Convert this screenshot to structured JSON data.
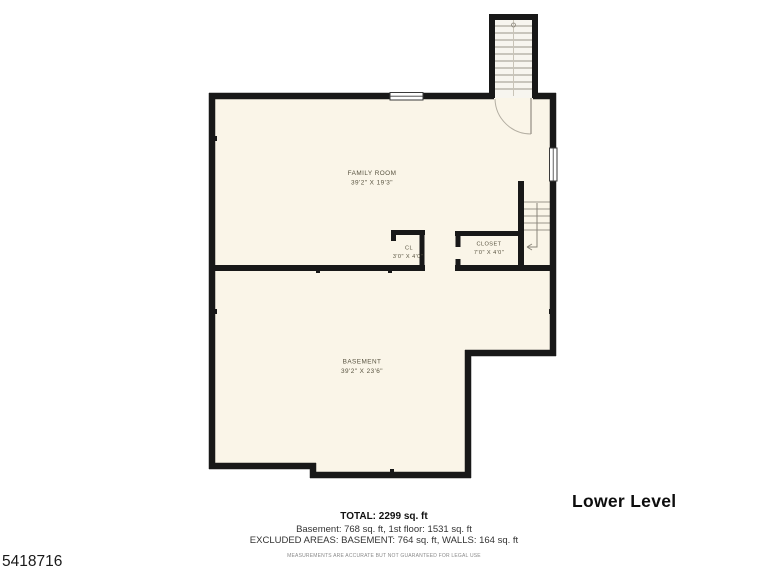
{
  "plan": {
    "wall_color": "#181818",
    "floor_fill": "#faf5e8",
    "stair_fill": "#f7f5ef",
    "detail_color": "#9a958a",
    "rooms": [
      {
        "id": "family-room",
        "name": "FAMILY ROOM",
        "dims": "39'2\" X 19'3\""
      },
      {
        "id": "cl",
        "name": "CL",
        "dims": "3'0\" X 4'0\""
      },
      {
        "id": "closet",
        "name": "CLOSET",
        "dims": "7'0\" X 4'0\""
      },
      {
        "id": "basement",
        "name": "BASEMENT",
        "dims": "39'2\" X 23'6\""
      }
    ]
  },
  "level_title": "Lower Level",
  "summary": {
    "total": "TOTAL: 2299 sq. ft",
    "breakdown": "Basement: 768 sq. ft, 1st floor: 1531 sq. ft",
    "excluded": "EXCLUDED AREAS: BASEMENT: 764 sq. ft, WALLS: 164 sq. ft",
    "disclaimer": "MEASUREMENTS ARE ACCURATE BUT NOT GUARANTEED FOR LEGAL USE"
  },
  "listing_id": "5418716"
}
